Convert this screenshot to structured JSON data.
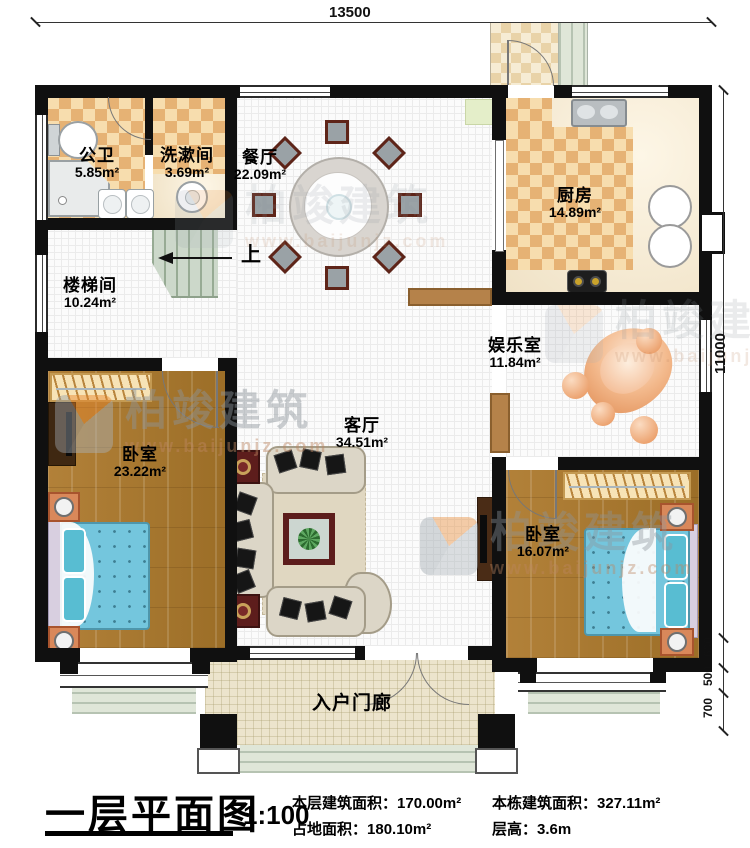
{
  "dims": {
    "top": "13500",
    "right": "11000",
    "seg600": "600",
    "seg500": "500",
    "seg700": "700"
  },
  "rooms": {
    "gongwei": {
      "name": "公卫",
      "area": "5.85m²"
    },
    "xishujian": {
      "name": "洗漱间",
      "area": "3.69m²"
    },
    "canting": {
      "name": "餐厅",
      "area": "22.09m²"
    },
    "chufang": {
      "name": "厨房",
      "area": "14.89m²"
    },
    "loutijian": {
      "name": "楼梯间",
      "area": "10.24m²"
    },
    "yuleshi": {
      "name": "娱乐室",
      "area": "11.84m²"
    },
    "keting": {
      "name": "客厅",
      "area": "34.51m²"
    },
    "woshi1": {
      "name": "卧室",
      "area": "23.22m²"
    },
    "woshi2": {
      "name": "卧室",
      "area": "16.07m²"
    },
    "porch": {
      "name": "入户门廊"
    }
  },
  "stair": {
    "up": "上"
  },
  "watermark": {
    "brand": "柏竣建筑",
    "site": "www.baijunjz.com"
  },
  "titleblock": {
    "title": "一层平面图",
    "scale": "1:100",
    "row1a_label": "本层建筑面积：",
    "row1a_value": "170.00m²",
    "row2a_label": "占地面积：",
    "row2a_value": "180.10m²",
    "row1b_label": "本栋建筑面积：",
    "row1b_value": "327.11m²",
    "row2b_label": "层高：",
    "row2b_value": "3.6m"
  }
}
